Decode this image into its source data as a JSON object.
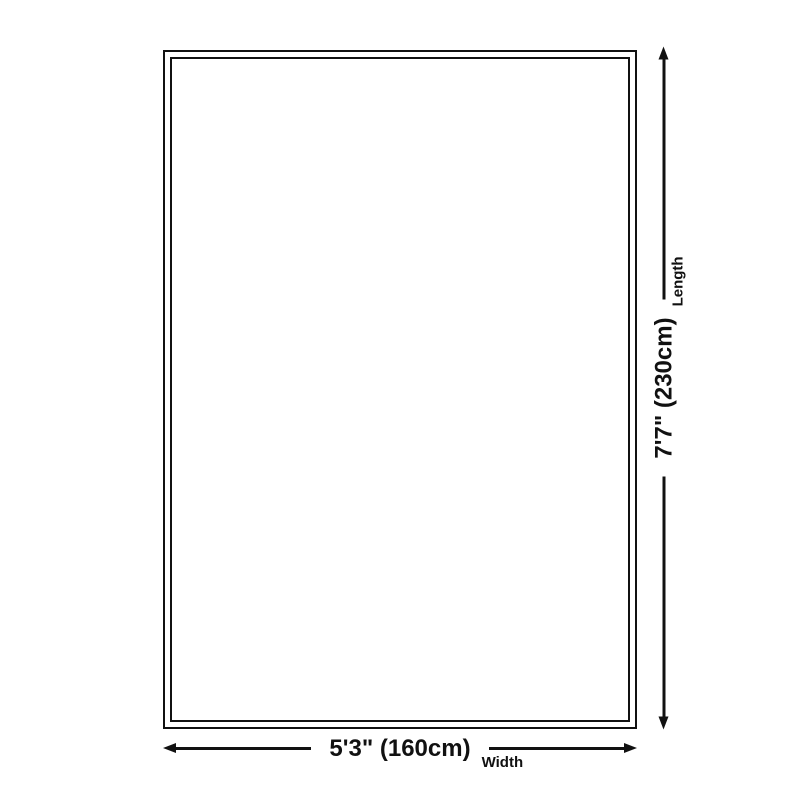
{
  "theme": {
    "ink_color": "#111111",
    "background_color": "#ffffff"
  },
  "diagram": {
    "width": {
      "value": "5'3\" (160cm)",
      "label": "Width"
    },
    "length": {
      "value": "7'7\" (230cm)",
      "label": "Length"
    }
  }
}
